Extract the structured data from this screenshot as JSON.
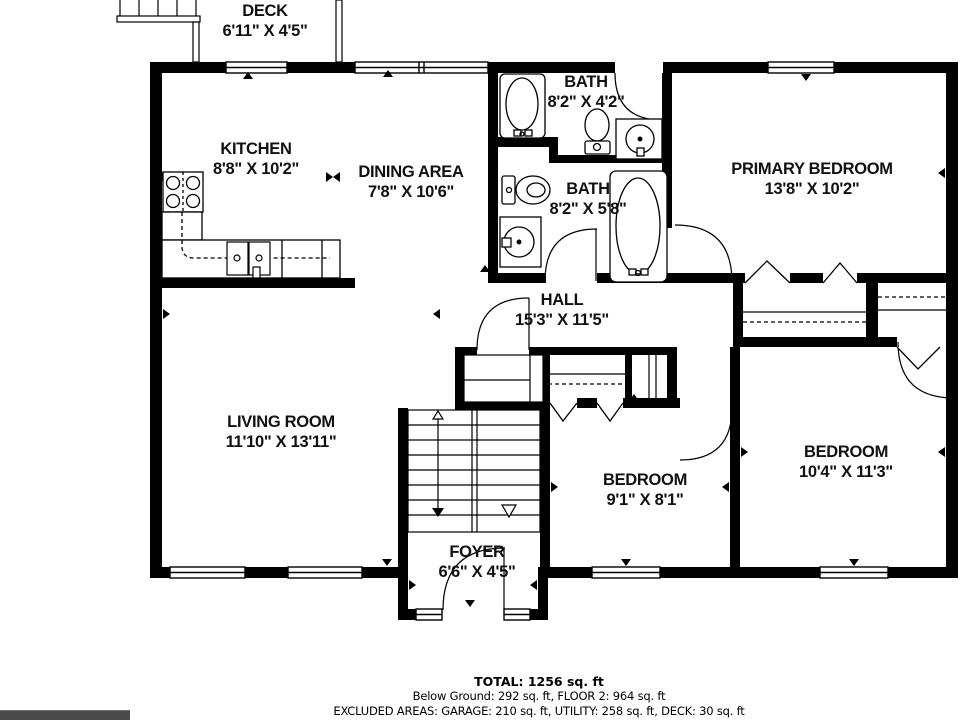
{
  "rooms": [
    {
      "name": "DECK",
      "dims": "6'11\" X 4'5\""
    },
    {
      "name": "KITCHEN",
      "dims": "8'8\" X 10'2\""
    },
    {
      "name": "DINING AREA",
      "dims": "7'8\" X 10'6\""
    },
    {
      "name": "BATH",
      "dims": "8'2\" X 4'2\""
    },
    {
      "name": "BATH",
      "dims": "8'2\" X 5'8\""
    },
    {
      "name": "PRIMARY BEDROOM",
      "dims": "13'8\" X 10'2\""
    },
    {
      "name": "HALL",
      "dims": "15'3\" X 11'5\""
    },
    {
      "name": "LIVING ROOM",
      "dims": "11'10\" X 13'11\""
    },
    {
      "name": "BEDROOM",
      "dims": "9'1\" X 8'1\""
    },
    {
      "name": "BEDROOM",
      "dims": "10'4\" X 11'3\""
    },
    {
      "name": "FOYER",
      "dims": "6'6\" X 4'5\""
    }
  ],
  "footer": {
    "total": "TOTAL: 1256 sq. ft",
    "line2": "Below Ground: 292 sq. ft, FLOOR 2: 964 sq. ft",
    "line3": "EXCLUDED AREAS: GARAGE: 210 sq. ft, UTILITY: 258 sq. ft, DECK: 30 sq. ft"
  },
  "colors": {
    "wall": "#000000",
    "background": "#ffffff",
    "bottom_bar": "#4a4a4a"
  }
}
